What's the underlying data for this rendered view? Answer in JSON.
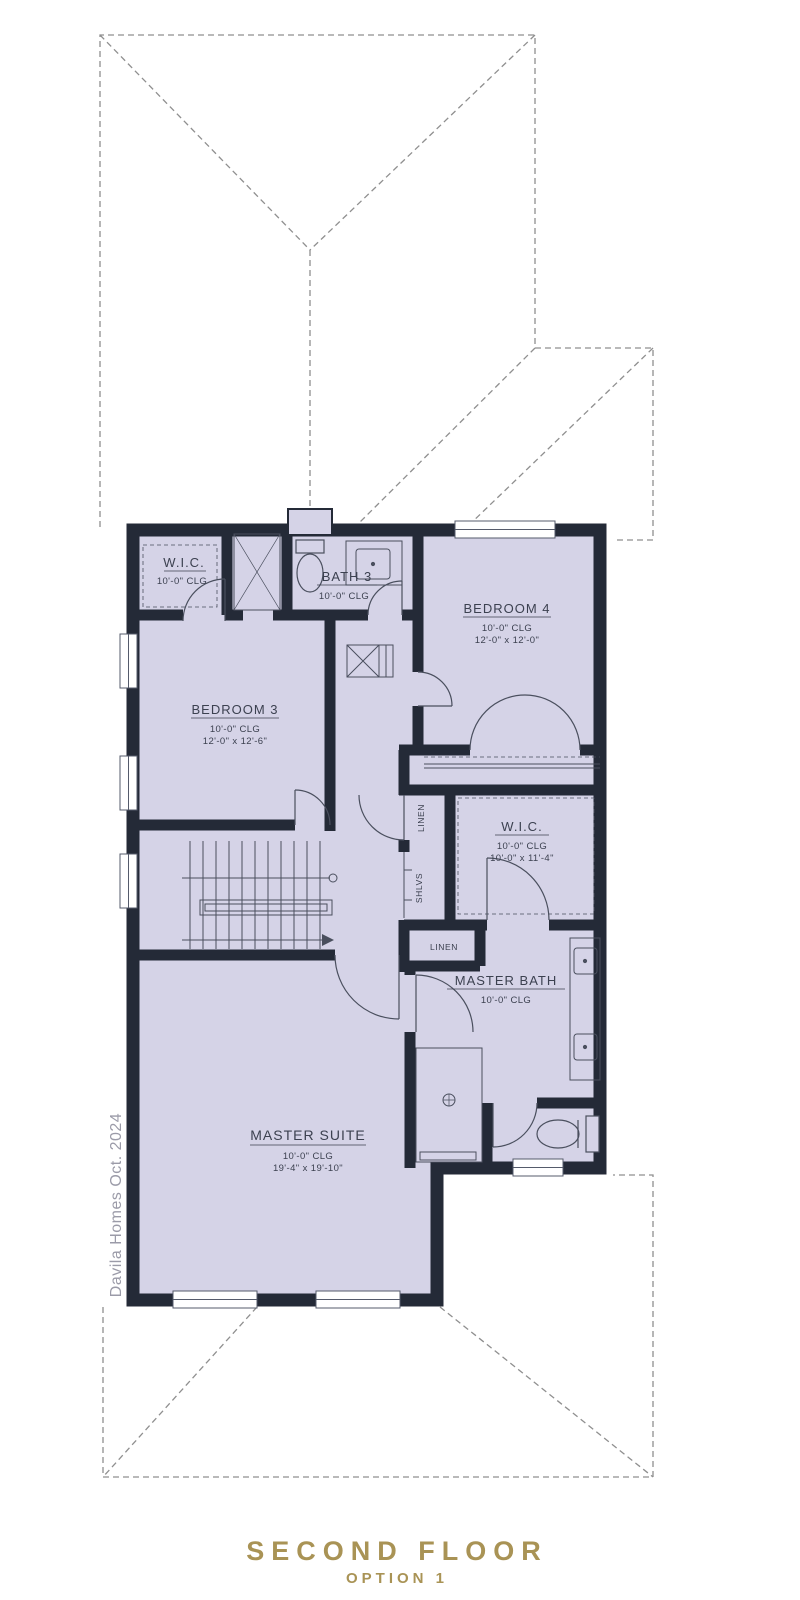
{
  "title": {
    "main": "SECOND FLOOR",
    "sub": "OPTION 1"
  },
  "watermark": "Davila Homes Oct. 2024",
  "rooms": {
    "wic3": {
      "name": "W.I.C.",
      "clg": "10'-0\" CLG"
    },
    "bath3": {
      "name": "BATH 3",
      "clg": "10'-0\" CLG"
    },
    "bedroom4": {
      "name": "BEDROOM 4",
      "clg": "10'-0\" CLG",
      "dims": "12'-0\" x 12'-0\""
    },
    "bedroom3": {
      "name": "BEDROOM 3",
      "clg": "10'-0\" CLG",
      "dims": "12'-0\" x 12'-6\""
    },
    "master_wic": {
      "name": "W.I.C.",
      "clg": "10'-0\" CLG",
      "dims": "10'-0\" x 11'-4\""
    },
    "master_bath": {
      "name": "MASTER BATH",
      "clg": "10'-0\" CLG"
    },
    "master_suite": {
      "name": "MASTER SUITE",
      "clg": "10'-0\" CLG",
      "dims": "19'-4\" x 19'-10\""
    },
    "linen_upper": {
      "name": "LINEN"
    },
    "shlvs": {
      "name": "SHLVS"
    },
    "linen_lower": {
      "name": "LINEN"
    }
  },
  "colors": {
    "floor": "#d5d3e7",
    "wall": "#242a37",
    "roof_dash": "#8f8f8f",
    "title_gold": "#a99355"
  }
}
